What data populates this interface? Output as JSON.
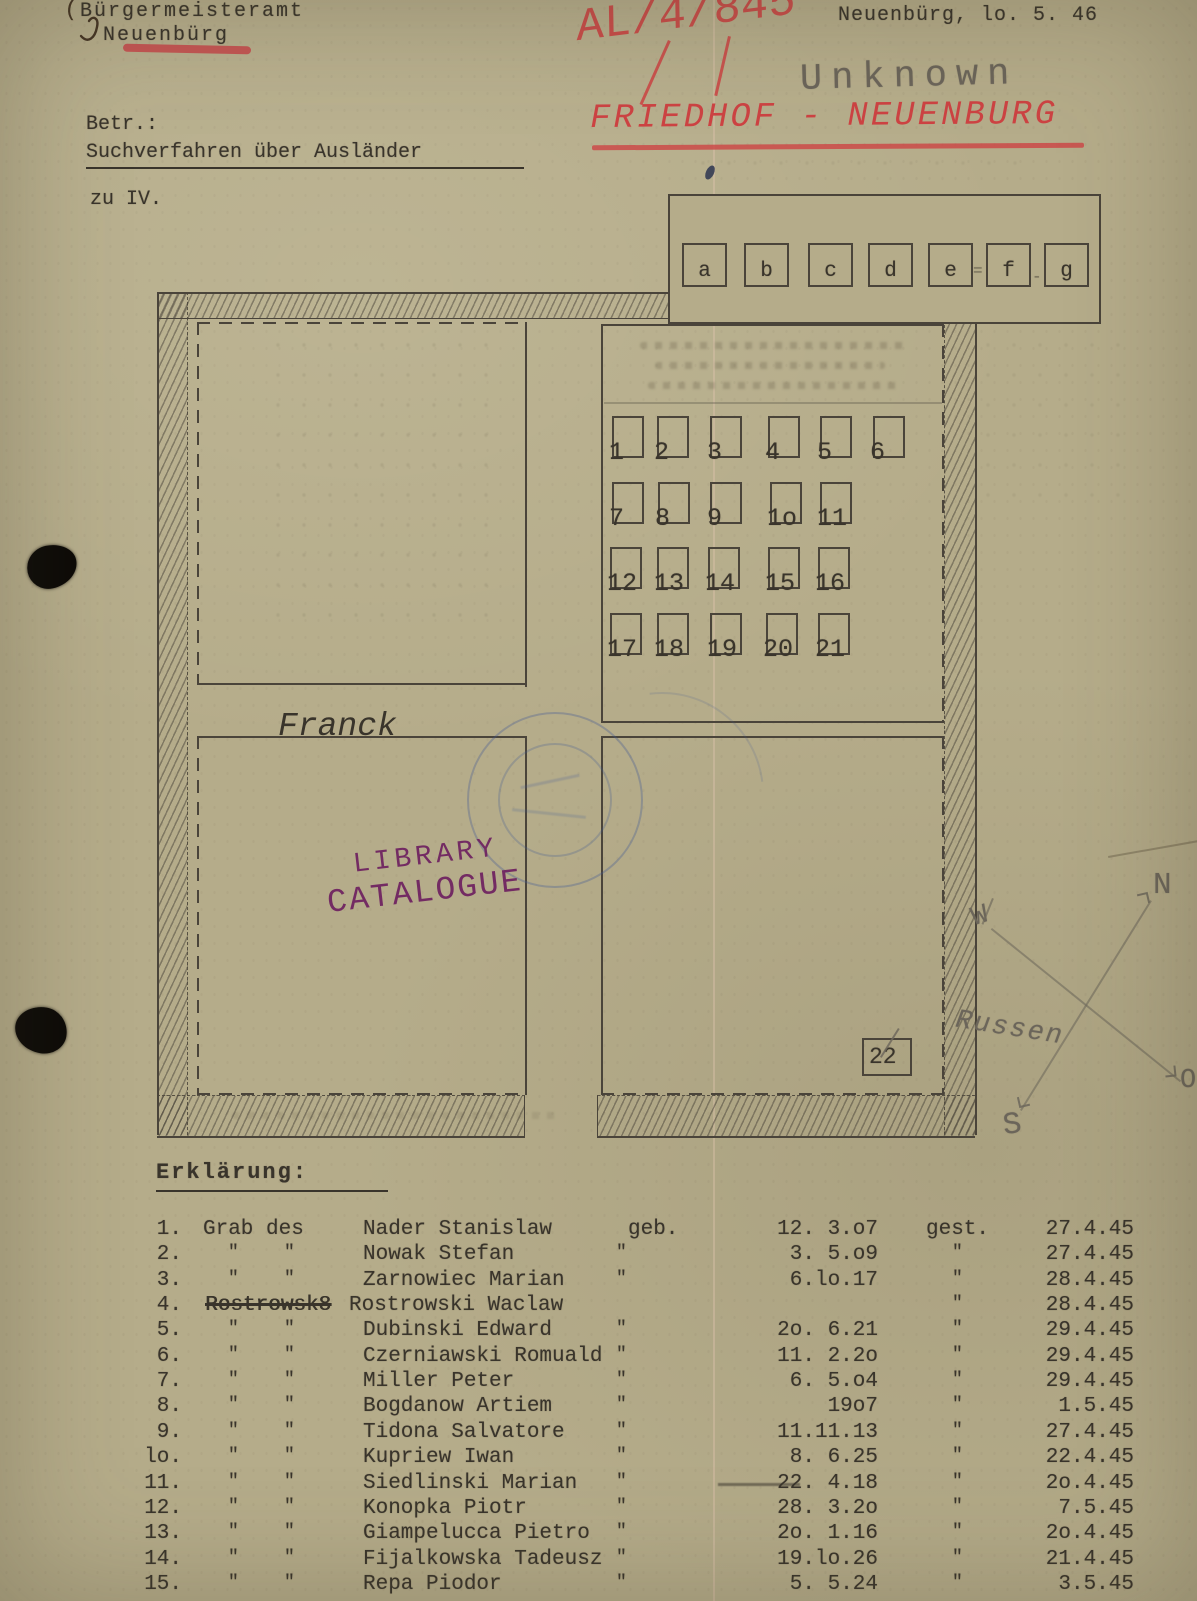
{
  "document": {
    "header": {
      "office_line1": "Bürgermeisteramt",
      "office_line2": "Neuenbürg",
      "place_date": "Neuenbürg, lo. 5. 46",
      "red_file_number": "AL/4/845",
      "pencil_note": "Unknown",
      "red_heading": "FRIEDHOF - NEUENBURG",
      "betreff_label": "Betr.:",
      "betreff_subject": "Suchverfahren über Ausländer",
      "reference_note": "zu IV."
    },
    "map": {
      "legend_cells": [
        "a",
        "b",
        "c",
        "d",
        "e",
        "f",
        "g"
      ],
      "legend_marks": [
        "=",
        "-"
      ],
      "grave_numbers": [
        [
          "1",
          "2",
          "3",
          "4",
          "5",
          "6"
        ],
        [
          "7",
          "8",
          "9",
          "1o",
          "11"
        ],
        [
          "12",
          "13",
          "14",
          "15",
          "16"
        ],
        [
          "17",
          "18",
          "19",
          "20",
          "21"
        ]
      ],
      "isolated_grave": "22",
      "compass": {
        "north": "N",
        "south": "S",
        "west": "W",
        "east": "O",
        "note": "Russen"
      }
    },
    "stamps": {
      "library_stamp_line1": "LIBRARY",
      "library_stamp_line2": "CATALOGUE",
      "blue_signature": "Franck"
    },
    "list": {
      "heading": "Erklärung:",
      "rows": [
        {
          "num": "1.",
          "grab_label": "Grab des",
          "ditto1": "",
          "ditto2": "",
          "struck": "",
          "name": "Nader Stanislaw",
          "geb": "geb.",
          "born": "12. 3.o7",
          "gest": "gest.",
          "died": "27.4.45"
        },
        {
          "num": "2.",
          "grab_label": "",
          "ditto1": "\"",
          "ditto2": "\"",
          "struck": "",
          "name": "Nowak Stefan",
          "geb": "\"",
          "born": "3. 5.o9",
          "gest": "\"",
          "died": "27.4.45"
        },
        {
          "num": "3.",
          "grab_label": "",
          "ditto1": "\"",
          "ditto2": "\"",
          "struck": "",
          "name": "Zarnowiec Marian",
          "geb": "\"",
          "born": "6.lo.17",
          "gest": "\"",
          "died": "28.4.45"
        },
        {
          "num": "4.",
          "grab_label": "",
          "ditto1": "",
          "ditto2": "",
          "struck": "Rostrowsk8",
          "name": "Rostrowski Waclaw",
          "geb": "",
          "born": "",
          "gest": "\"",
          "died": "28.4.45"
        },
        {
          "num": "5.",
          "grab_label": "",
          "ditto1": "\"",
          "ditto2": "\"",
          "struck": "",
          "name": "Dubinski Edward",
          "geb": "\"",
          "born": "2o. 6.21",
          "gest": "\"",
          "died": "29.4.45"
        },
        {
          "num": "6.",
          "grab_label": "",
          "ditto1": "\"",
          "ditto2": "\"",
          "struck": "",
          "name": "Czerniawski Romuald",
          "geb": "\"",
          "born": "11. 2.2o",
          "gest": "\"",
          "died": "29.4.45"
        },
        {
          "num": "7.",
          "grab_label": "",
          "ditto1": "\"",
          "ditto2": "\"",
          "struck": "",
          "name": "Miller Peter",
          "geb": "\"",
          "born": "6. 5.o4",
          "gest": "\"",
          "died": "29.4.45"
        },
        {
          "num": "8.",
          "grab_label": "",
          "ditto1": "\"",
          "ditto2": "\"",
          "struck": "",
          "name": "Bogdanow Artiem",
          "geb": "\"",
          "born": "19o7",
          "gest": "\"",
          "died": "1.5.45"
        },
        {
          "num": "9.",
          "grab_label": "",
          "ditto1": "\"",
          "ditto2": "\"",
          "struck": "",
          "name": "Tidona Salvatore",
          "geb": "\"",
          "born": "11.11.13",
          "gest": "\"",
          "died": "27.4.45"
        },
        {
          "num": "lo.",
          "grab_label": "",
          "ditto1": "\"",
          "ditto2": "\"",
          "struck": "",
          "name": "Kupriew Iwan",
          "geb": "\"",
          "born": "8. 6.25",
          "gest": "\"",
          "died": "22.4.45"
        },
        {
          "num": "11.",
          "grab_label": "",
          "ditto1": "\"",
          "ditto2": "\"",
          "struck": "",
          "name": "Siedlinski Marian",
          "geb": "\"",
          "born": "22. 4.18",
          "born_struck": true,
          "gest": "\"",
          "died": "2o.4.45"
        },
        {
          "num": "12.",
          "grab_label": "",
          "ditto1": "\"",
          "ditto2": "\"",
          "struck": "",
          "name": "Konopka Piotr",
          "geb": "\"",
          "born": "28. 3.2o",
          "gest": "\"",
          "died": "7.5.45"
        },
        {
          "num": "13.",
          "grab_label": "",
          "ditto1": "\"",
          "ditto2": "\"",
          "struck": "",
          "name": "Giampelucca Pietro",
          "geb": "\"",
          "born": "2o. 1.16",
          "gest": "\"",
          "died": "2o.4.45"
        },
        {
          "num": "14.",
          "grab_label": "",
          "ditto1": "\"",
          "ditto2": "\"",
          "struck": "",
          "name": "Fijalkowska Tadeusz",
          "geb": "\"",
          "born": "19.lo.26",
          "gest": "\"",
          "died": "21.4.45"
        },
        {
          "num": "15.",
          "grab_label": "",
          "ditto1": "\"",
          "ditto2": "\"",
          "struck": "",
          "name": "Repa Piodor",
          "geb": "\"",
          "born": "5. 5.24",
          "gest": "\"",
          "died": "3.5.45"
        }
      ]
    }
  }
}
